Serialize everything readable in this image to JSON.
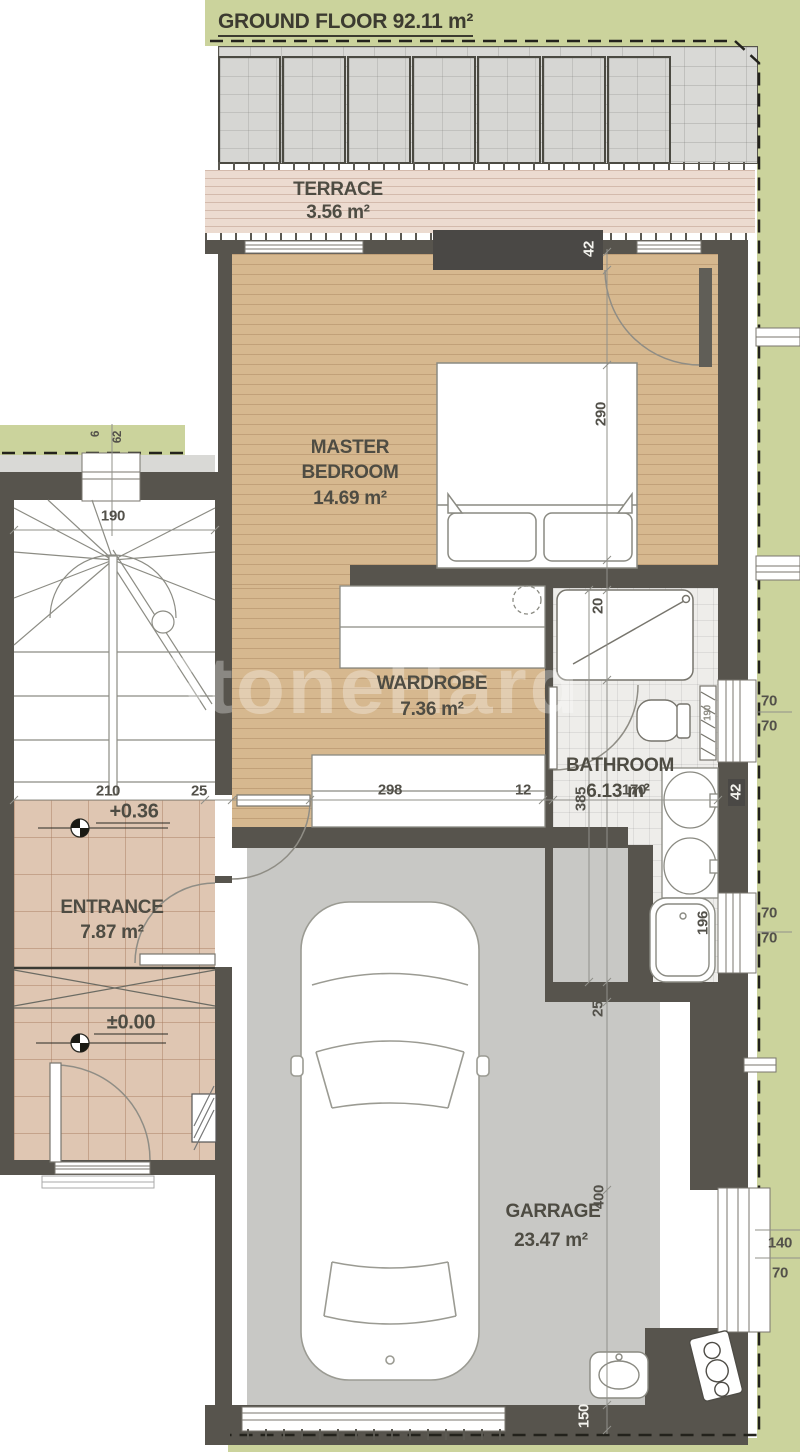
{
  "title": "GROUND FLOOR 92.11 m²",
  "watermark": "StoneHard",
  "rooms": {
    "terrace": {
      "name": "TERRACE",
      "area": "3.56 m²"
    },
    "master_bedroom": {
      "line1": "MASTER",
      "line2": "BEDROOM",
      "area": "14.69 m²"
    },
    "wardrobe": {
      "name": "WARDROBE",
      "area": "7.36 m²"
    },
    "bathroom": {
      "name": "BATHROOM",
      "area": "6.13 m²"
    },
    "entrance": {
      "name": "ENTRANCE",
      "area": "7.87 m²"
    },
    "garage": {
      "name": "GARRAGE",
      "area": "23.47 m²"
    }
  },
  "levels": {
    "upper": "+0.36",
    "ground": "±0.00"
  },
  "dims": {
    "terrace_door": "42",
    "bedroom_depth": "290",
    "stairs_width": "190",
    "left_window_a": "6",
    "left_window_b": "62",
    "entrance_width": "210",
    "entrance_wall": "25",
    "closet_run": "298",
    "closet_gap": "12",
    "shower_width": "20",
    "bathroom_depth": "385",
    "bathroom_width": "170",
    "radiator": "190",
    "fixture_door": "42",
    "bath_window_a": "70",
    "bath_window_b": "70",
    "tub_length": "196",
    "tub_window_a": "70",
    "tub_window_b": "70",
    "garage_wall": "25",
    "garage_depth": "400",
    "garage_window_a": "140",
    "garage_window_b": "70",
    "garage_door": "150"
  },
  "colors": {
    "site_green": "#cbd39c",
    "wall": "#57544d",
    "wood_floor": "#d6b88f",
    "entrance_tile": "#dfc6b2",
    "terrace_deck": "#ecdbd0",
    "garage_floor": "#c8c8c5",
    "text": "#4e4c43"
  }
}
